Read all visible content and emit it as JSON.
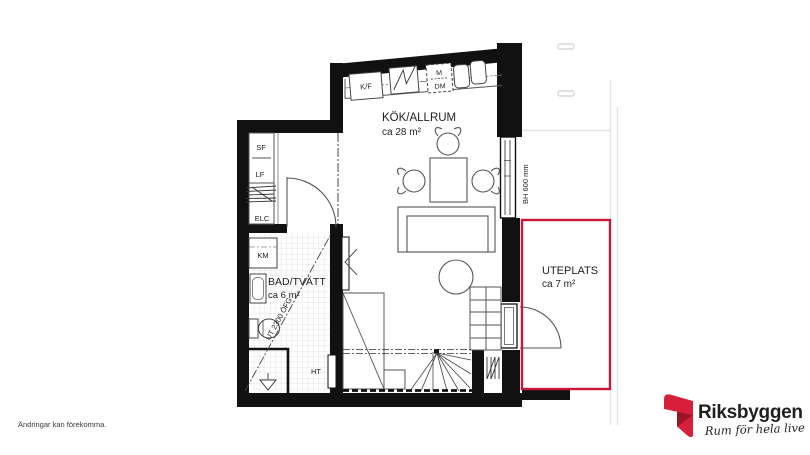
{
  "disclaimer": "Ändringar kan förekomma.",
  "rooms": {
    "main": {
      "name": "KÖK/ALLRUM",
      "area": "ca 28 m²"
    },
    "bath": {
      "name": "BAD/TVÄTT",
      "area": "ca 6 m²"
    },
    "patio": {
      "name": "UTEPLATS",
      "area": "ca 7 m²"
    }
  },
  "labels": {
    "tall_cabinet": "SF",
    "linen_cabinet": "LF",
    "electrical_cabinet": "ELC",
    "washing_machine": "KM",
    "fridge_freezer": "K/F",
    "microwave": "M",
    "dishwasher": "DM",
    "towel_dryer": "HT"
  },
  "annotations": {
    "window_sill_height": "BH 600 mm",
    "ceiling_height_line": "UT 2300 ÖFG"
  },
  "logo": {
    "brand": "Riksbyggen",
    "tagline": "Rum för hela livet"
  },
  "colors": {
    "wall": "#111111",
    "patio_highlight": "#c8193c",
    "logo_red": "#d71f3c",
    "logo_dark_red": "#9c1526",
    "logo_gray": "#8b8d8e"
  }
}
